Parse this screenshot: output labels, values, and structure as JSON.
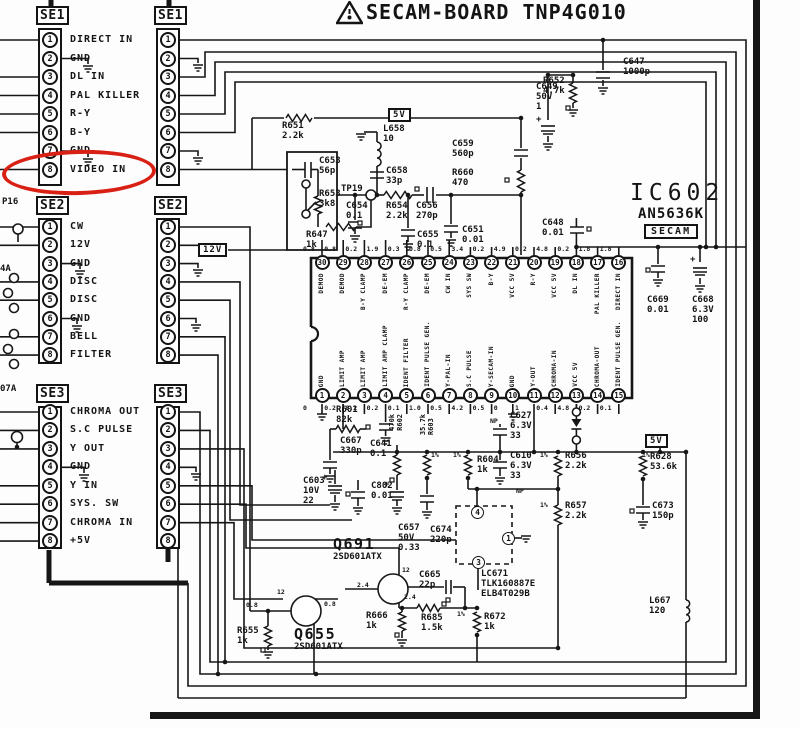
{
  "title": {
    "warning_icon": "warning-triangle-icon",
    "text": "SECAM-BOARD TNP4G010"
  },
  "ic": {
    "ref": "IC602",
    "part": "AN5636K",
    "standard": "SECAM",
    "top_pins": [
      {
        "n": 30,
        "label": "DEMOD",
        "voltage": "0.8"
      },
      {
        "n": 29,
        "label": "DEMOD",
        "voltage": "0.8"
      },
      {
        "n": 28,
        "label": "B-Y CLAMP",
        "voltage": "0.2"
      },
      {
        "n": 27,
        "label": "DE-EM",
        "voltage": "1.9"
      },
      {
        "n": 26,
        "label": "R-Y CLAMP",
        "voltage": "0.3"
      },
      {
        "n": 25,
        "label": "DE-EM",
        "voltage": "0.8"
      },
      {
        "n": 24,
        "label": "CW IN",
        "voltage": "0.5"
      },
      {
        "n": 23,
        "label": "SYS SW",
        "voltage": "3.4"
      },
      {
        "n": 22,
        "label": "B-Y",
        "voltage": "0.2"
      },
      {
        "n": 21,
        "label": "VCC 5V",
        "voltage": "4.9"
      },
      {
        "n": 20,
        "label": "R-Y",
        "voltage": "0.2"
      },
      {
        "n": 19,
        "label": "VCC 5V",
        "voltage": "4.8"
      },
      {
        "n": 18,
        "label": "DL IN",
        "voltage": "0.2"
      },
      {
        "n": 17,
        "label": "PAL KILLER",
        "voltage": "1.8"
      },
      {
        "n": 16,
        "label": "DIRECT IN",
        "voltage": "1.8"
      }
    ],
    "bottom_pins": [
      {
        "n": 1,
        "label": "GND",
        "voltage": "0"
      },
      {
        "n": 2,
        "label": "LIMIT AMP",
        "voltage": "0.2"
      },
      {
        "n": 3,
        "label": "LIMIT AMP",
        "voltage": "0.2"
      },
      {
        "n": 4,
        "label": "LIMIT AMP CLAMP",
        "voltage": "0.2"
      },
      {
        "n": 5,
        "label": "IDENT FILTER",
        "voltage": "0.1"
      },
      {
        "n": 6,
        "label": "IDENT PULSE GEN.",
        "voltage": "1.0"
      },
      {
        "n": 7,
        "label": "Y-PAL-IN",
        "voltage": "0.5"
      },
      {
        "n": 8,
        "label": "S.C PULSE",
        "voltage": "4.2"
      },
      {
        "n": 9,
        "label": "Y-SECAM-IN",
        "voltage": "0.5"
      },
      {
        "n": 10,
        "label": "GND",
        "voltage": "0"
      },
      {
        "n": 11,
        "label": "Y-OUT",
        "voltage": "1"
      },
      {
        "n": 12,
        "label": "CHROMA-IN",
        "voltage": "0.4"
      },
      {
        "n": 13,
        "label": "VCC 5V",
        "voltage": "4.8"
      },
      {
        "n": 14,
        "label": "CHROMA-OUT",
        "voltage": "0.2"
      },
      {
        "n": 15,
        "label": "IDENT PULSE GEN.",
        "voltage": "0.1"
      }
    ]
  },
  "connectors_left": [
    {
      "name": "SE1",
      "pins": [
        {
          "n": 1,
          "label": "DIRECT IN"
        },
        {
          "n": 2,
          "label": "GND"
        },
        {
          "n": 3,
          "label": "DL IN"
        },
        {
          "n": 4,
          "label": "PAL KILLER"
        },
        {
          "n": 5,
          "label": "R-Y"
        },
        {
          "n": 6,
          "label": "B-Y"
        },
        {
          "n": 7,
          "label": "GND"
        },
        {
          "n": 8,
          "label": "VIDEO IN"
        }
      ]
    },
    {
      "name": "SE2",
      "pins": [
        {
          "n": 1,
          "label": "CW"
        },
        {
          "n": 2,
          "label": "12V"
        },
        {
          "n": 3,
          "label": "GND"
        },
        {
          "n": 4,
          "label": "DISC"
        },
        {
          "n": 5,
          "label": "DISC"
        },
        {
          "n": 6,
          "label": "GND"
        },
        {
          "n": 7,
          "label": "BELL"
        },
        {
          "n": 8,
          "label": "FILTER"
        }
      ]
    },
    {
      "name": "SE3",
      "pins": [
        {
          "n": 1,
          "label": "CHROMA OUT"
        },
        {
          "n": 2,
          "label": "S.C PULSE"
        },
        {
          "n": 3,
          "label": "Y OUT"
        },
        {
          "n": 4,
          "label": "GND"
        },
        {
          "n": 5,
          "label": "Y IN"
        },
        {
          "n": 6,
          "label": "SYS. SW"
        },
        {
          "n": 7,
          "label": "CHROMA IN"
        },
        {
          "n": 8,
          "label": "+5V"
        }
      ]
    }
  ],
  "connectors_inner": [
    {
      "name": "SE1",
      "pins": [
        {
          "n": 1
        },
        {
          "n": 2
        },
        {
          "n": 3
        },
        {
          "n": 4
        },
        {
          "n": 5
        },
        {
          "n": 6
        },
        {
          "n": 7
        },
        {
          "n": 8
        }
      ]
    },
    {
      "name": "SE2",
      "pins": [
        {
          "n": 1
        },
        {
          "n": 2
        },
        {
          "n": 3
        },
        {
          "n": 4
        },
        {
          "n": 5
        },
        {
          "n": 6
        },
        {
          "n": 7
        },
        {
          "n": 8
        }
      ]
    },
    {
      "name": "SE3",
      "pins": [
        {
          "n": 1
        },
        {
          "n": 2
        },
        {
          "n": 3
        },
        {
          "n": 4
        },
        {
          "n": 5
        },
        {
          "n": 6
        },
        {
          "n": 7
        },
        {
          "n": 8
        }
      ]
    }
  ],
  "power_labels": {
    "v5_top": "5V",
    "v5_right": "5V",
    "v12": "12V"
  },
  "edge_fragments": {
    "f1": "P16",
    "f2": "4A",
    "f3": "07A"
  },
  "annotation_circle": {
    "target": "SE1 pin 8 VIDEO IN",
    "color": "#d92015"
  },
  "components": {
    "r651": {
      "ref": "R651",
      "v1": "2.2k"
    },
    "r652": {
      "ref": "R652",
      "v1": "4.7k"
    },
    "c647": {
      "ref": "C647",
      "v1": "1000p"
    },
    "c649": {
      "ref": "C649",
      "v1": "50V",
      "v2": "1"
    },
    "c653": {
      "ref": "C653",
      "v1": "56p"
    },
    "r653": {
      "ref": "R653",
      "v1": "3k8"
    },
    "r647": {
      "ref": "R647",
      "v1": "1k"
    },
    "tp19": {
      "ref": "TP19",
      "v1": ""
    },
    "l658": {
      "ref": "L658",
      "v1": "10"
    },
    "c658": {
      "ref": "C658",
      "v1": "33p"
    },
    "c654": {
      "ref": "C654",
      "v1": "0.1"
    },
    "r654": {
      "ref": "R654",
      "v1": "2.2k"
    },
    "c656": {
      "ref": "C656",
      "v1": "270p"
    },
    "c659": {
      "ref": "C659",
      "v1": "560p"
    },
    "r660": {
      "ref": "R660",
      "v1": "470"
    },
    "c655": {
      "ref": "C655",
      "v1": "0.1"
    },
    "c651": {
      "ref": "C651",
      "v1": "0.01"
    },
    "c648": {
      "ref": "C648",
      "v1": "0.01"
    },
    "c669": {
      "ref": "C669",
      "v1": "0.01"
    },
    "c668": {
      "ref": "C668",
      "v1": "6.3V",
      "v2": "100"
    },
    "r601": {
      "ref": "R601",
      "v1": "82k"
    },
    "c667": {
      "ref": "C667",
      "v1": "330p"
    },
    "c641": {
      "ref": "C641",
      "v1": "0.1"
    },
    "r602": {
      "ref": "R602",
      "v1": "470k"
    },
    "r603": {
      "ref": "R603",
      "v1": "35.7k"
    },
    "c627": {
      "ref": "C627",
      "v1": "6.3V",
      "v2": "33"
    },
    "r604": {
      "ref": "R604",
      "v1": "1k"
    },
    "c610": {
      "ref": "C610",
      "v1": "6.3V",
      "v2": "33"
    },
    "c603": {
      "ref": "C603",
      "v1": "10V",
      "v2": "22"
    },
    "c802": {
      "ref": "C802",
      "v1": "0.01"
    },
    "c657": {
      "ref": "C657",
      "v1": "50V",
      "v2": "0.33"
    },
    "c674": {
      "ref": "C674",
      "v1": "220p"
    },
    "q691": {
      "ref": "Q691",
      "v1": "2SD601ATX"
    },
    "r656": {
      "ref": "R656",
      "v1": "2.2k"
    },
    "r657": {
      "ref": "R657",
      "v1": "2.2k"
    },
    "r628": {
      "ref": "R628",
      "v1": "53.6k"
    },
    "c673": {
      "ref": "C673",
      "v1": "150p"
    },
    "lc671": {
      "ref": "LC671",
      "v1": "TLK160887E",
      "v2": "ELB4T029B"
    },
    "c665": {
      "ref": "C665",
      "v1": "22p"
    },
    "q655": {
      "ref": "Q655",
      "v1": "2SD601ATX"
    },
    "r655": {
      "ref": "R655",
      "v1": "1k"
    },
    "r666": {
      "ref": "R666",
      "v1": "1k"
    },
    "r685": {
      "ref": "R685",
      "v1": "1.5k"
    },
    "r672": {
      "ref": "R672",
      "v1": "1k"
    },
    "l667": {
      "ref": "L667",
      "v1": "120"
    }
  },
  "annotations": {
    "percent": "1%",
    "np": "NP",
    "q655": {
      "c": "12",
      "b": "0.8",
      "e": "0.8"
    },
    "q691": {
      "c": "12",
      "b": "2.4",
      "e": "2.4"
    },
    "lc671_pins": [
      "4",
      "1",
      "3"
    ]
  }
}
